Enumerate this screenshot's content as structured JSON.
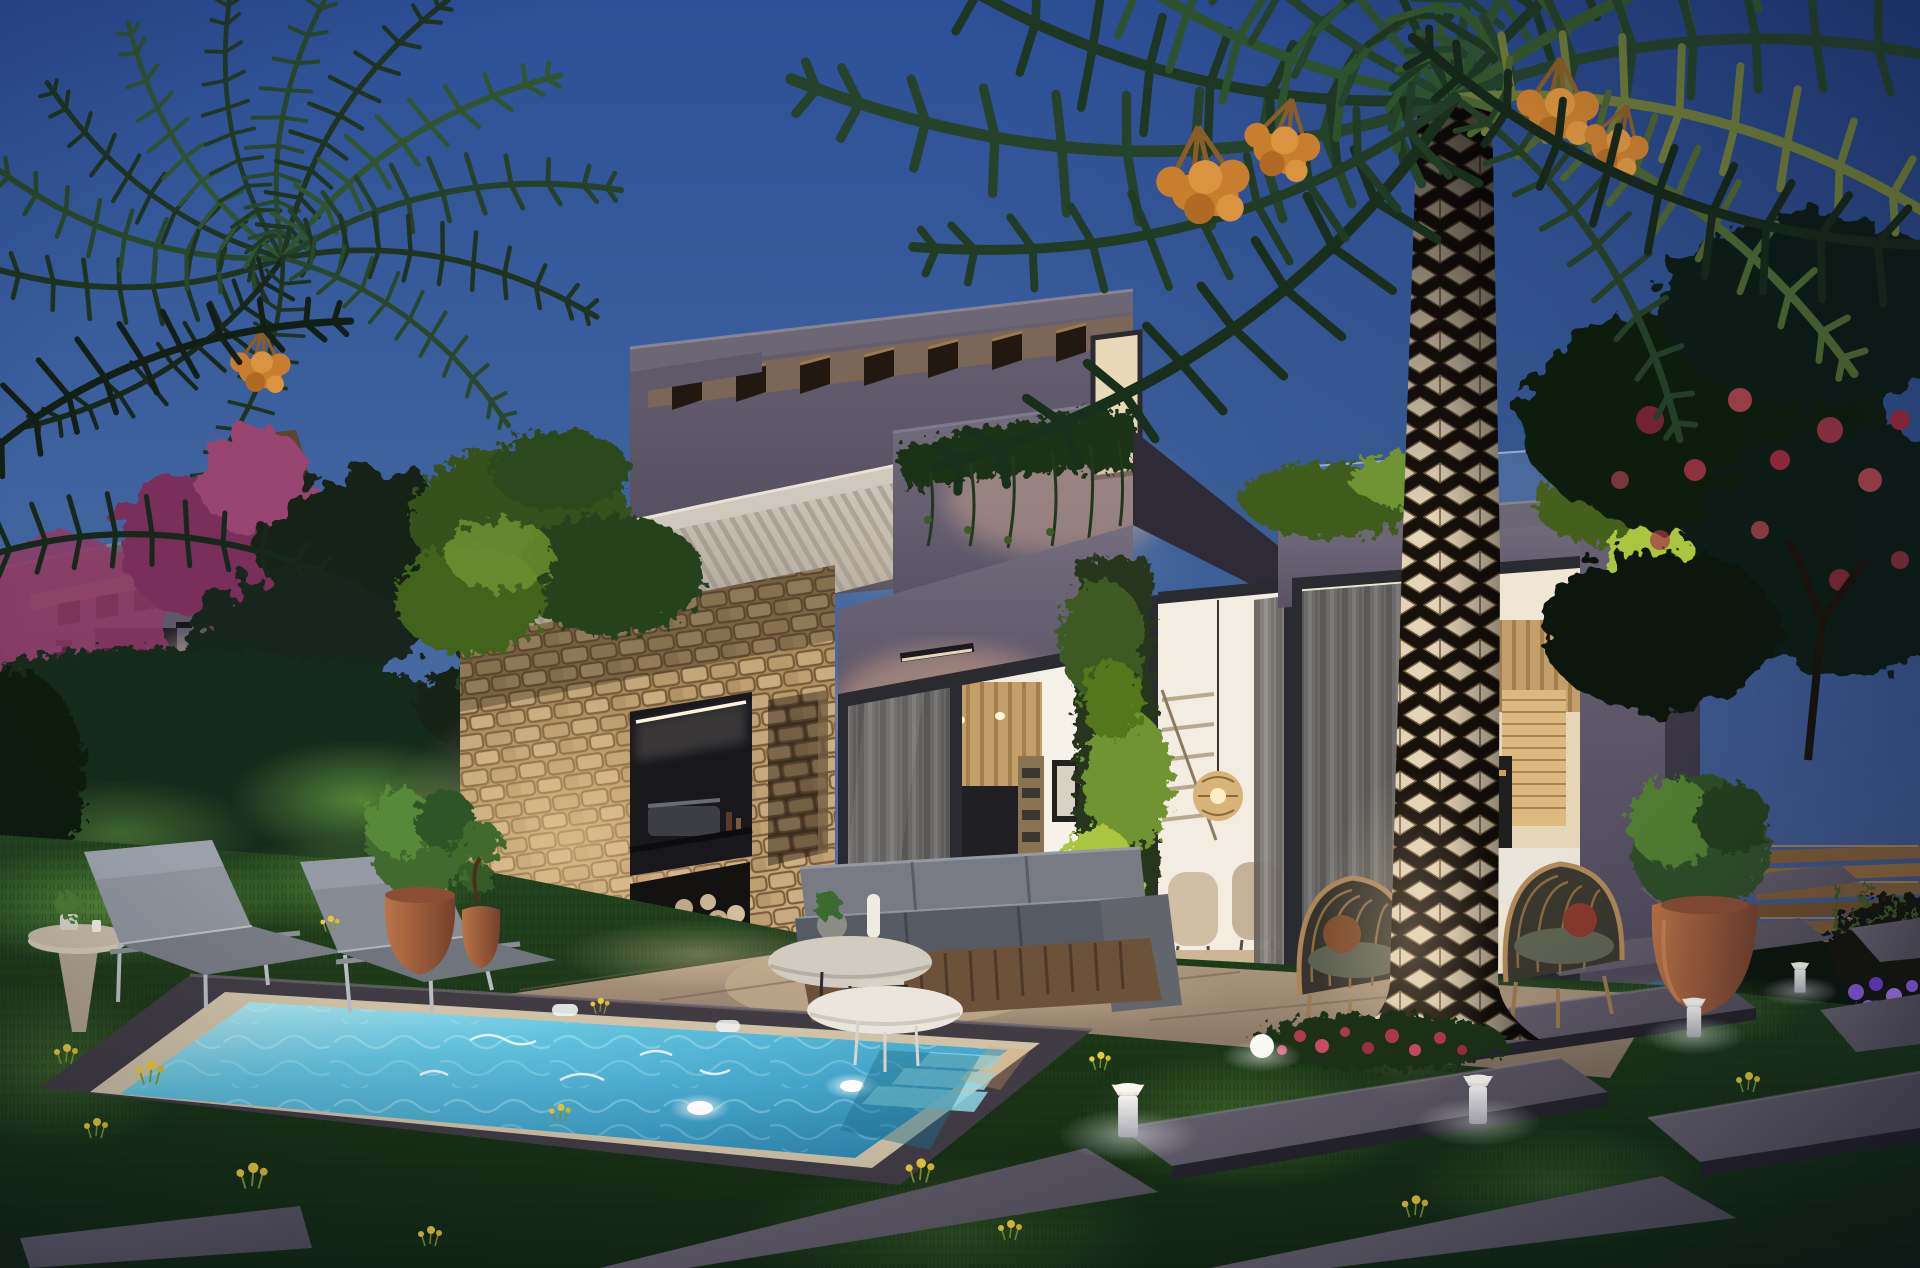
{
  "scene": {
    "type": "photorealistic architectural render",
    "subject": "modern two-storey concrete villa with garden and private pool",
    "time_of_day": "dusk",
    "no_visible_text": true
  },
  "palette": {
    "sky-top": "#2d4f97",
    "sky-mid": "#41669f",
    "sky-horizon": "#5a70a2",
    "concrete-dark": "#4f4a5a",
    "concrete-mid": "#615b6b",
    "concrete-light": "#7b7483",
    "beam-wood": "#8a6b4a",
    "beam-dark": "#241a11",
    "canopy-light": "#d9d3c7",
    "canopy-shade": "#a9a194",
    "stone-light": "#cdae82",
    "stone-dark": "#8a7252",
    "glass-frame": "#2a2a31",
    "curtain-gray": "#7e7a76",
    "interior-white": "#f2ece1",
    "interior-wood": "#c59f6a",
    "ivy-bright": "#aac63f",
    "ivy-mid": "#6f9431",
    "foliage-dark": "#15291a",
    "lawn-dark": "#142a12",
    "lawn-mid": "#24461f",
    "lawn-lit": "#6fae46",
    "pool-shallow": "#bdebf1",
    "pool-mid": "#64c4de",
    "pool-deep": "#2f86ad",
    "coping-light": "#cfc2a6",
    "coping-dark": "#413c44",
    "terrace-light": "#b29b82",
    "terrace-dark": "#7e6e5c",
    "terracotta": "#bc7448",
    "terracotta-dark": "#74412c",
    "trunk-diamond": "#e3d4b6",
    "trunk-dark": "#17110c",
    "fabric-gray": "#787b83",
    "fabric-dark": "#565a62",
    "warm-light": "#f3ddb2",
    "date-orange": "#c97e2f",
    "flower-red": "#b43a50",
    "flower-magenta": "#8e3a66",
    "flower-purple": "#8a5ce0",
    "dandelion-yellow": "#e7c93e",
    "slab-top": "#56515c",
    "slab-side": "#26232a",
    "fence-wood": "#7a5a36",
    "white": "#f4f3f0"
  },
  "objects": [
    "sky",
    "background-villa",
    "left-palm-tree",
    "garden-hedge",
    "bougainvillea",
    "tropical-tree",
    "villa-upper-floor",
    "roof-pergola-beams",
    "balcony-planter",
    "balcony-led-light",
    "upper-window",
    "white-slat-canopy",
    "stone-feature-wall",
    "bbq-niche",
    "firewood-niche",
    "outdoor-wall-light",
    "main-glass-doors",
    "living-room-interior",
    "hallway-interior",
    "ivy-column",
    "right-wing",
    "kitchen-interior",
    "glass-roof-balustrade",
    "flame-tree",
    "wooden-fence",
    "terrace-floor",
    "lawn",
    "swimming-pool",
    "pool-underwater-lights",
    "stepping-stones",
    "bollard-lights",
    "sun-loungers",
    "side-table",
    "outdoor-sofa",
    "coffee-tables",
    "rattan-armchairs",
    "terracotta-pots",
    "boxwood-ball",
    "foreground-palm-trunk",
    "palm-crown",
    "date-clusters",
    "flower-bed",
    "garden-ball-light",
    "dandelions"
  ]
}
